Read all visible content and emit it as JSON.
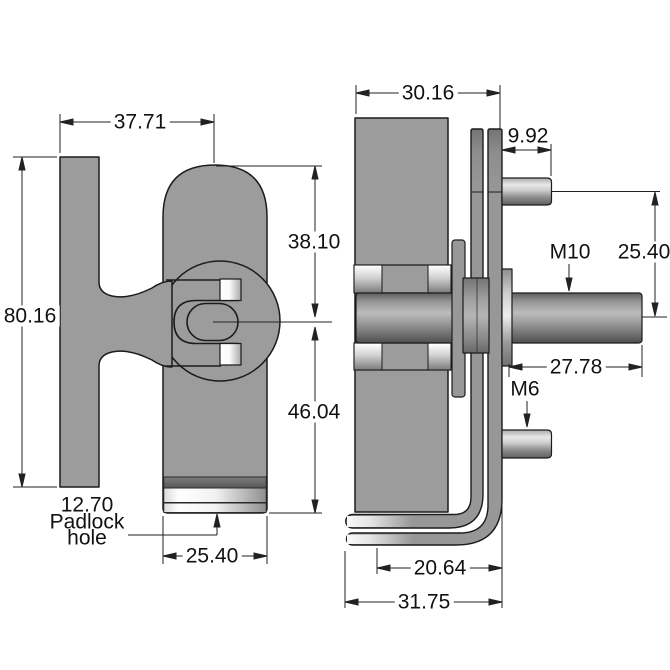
{
  "drawing": {
    "type": "engineering-drawing",
    "subject": "hasp-and-staple-latch",
    "units_shown": "mm"
  },
  "front_view": {
    "labels": {
      "width_top": "37.71",
      "overall_height": "80.16",
      "upper_offset": "38.10",
      "lower_offset": "46.04",
      "slot_width": "25.40",
      "padlock_note_line1": "12.70",
      "padlock_note_line2": "Padlock",
      "padlock_note_line3": "hole"
    }
  },
  "side_view": {
    "labels": {
      "depth": "30.16",
      "top_stud_length": "9.92",
      "main_thread": "M10",
      "stud_spacing": "25.40",
      "bolt_length": "27.78",
      "small_thread": "M6",
      "bracket_inner": "20.64",
      "bracket_outer": "31.75"
    }
  },
  "colors": {
    "background": "#ffffff",
    "part_fill": "#9c9c9c",
    "outline": "#1c1c1c",
    "dimension_line": "#222222",
    "text": "#111111",
    "highlight": "#ffffff"
  }
}
